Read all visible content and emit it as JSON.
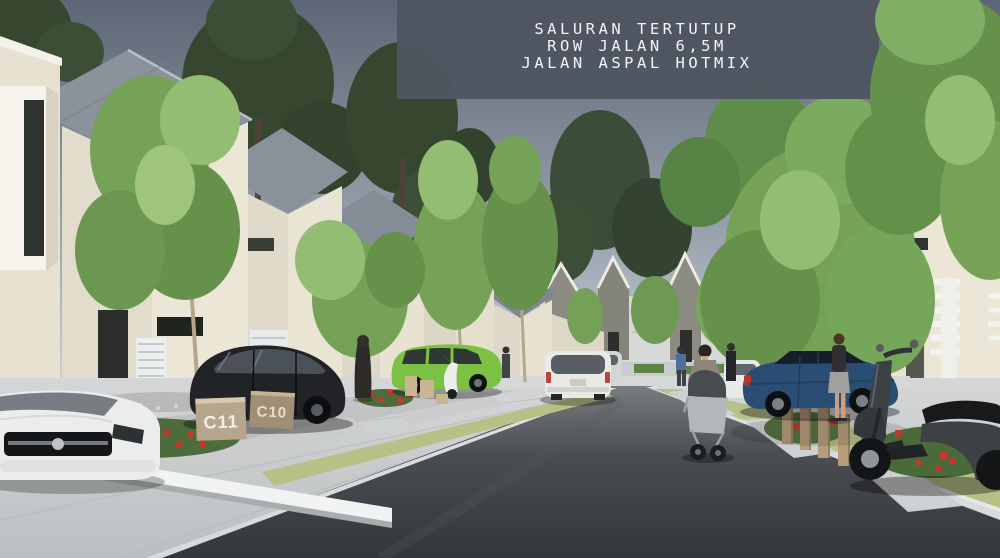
{
  "banner": {
    "lines": [
      "SALURAN TERTUTUP",
      "ROW JALAN 6,5M",
      "JALAN ASPAL HOTMIX"
    ],
    "bg_color": "#4e5561",
    "text_color": "#f3f4f6"
  },
  "unit_signs": {
    "sign_1": "C11",
    "sign_2": "C10"
  },
  "colors": {
    "sky_top": "#5d6675",
    "sky_mid": "#99a2ad",
    "sky_horizon": "#d7dce1",
    "asphalt_far": "#7a7d80",
    "asphalt_mid": "#4a4d51",
    "asphalt_near": "#33363a",
    "sidewalk": "#c8cbcd",
    "curb": "#e9ebec",
    "verge_green": "#b7c187",
    "house_wall": "#e7e1d2",
    "roof_gray": "#8b929b",
    "gable_facade": "#8b8b81",
    "slat_wall": "#d7d9d6",
    "pine_green": "#36462f",
    "tree_green": "#76a258",
    "tree_green_dark": "#65914b",
    "tree_green_light": "#93bd72",
    "flower_red": "#c0392b",
    "flower_bed_green": "#4e6b3c",
    "car_black": "#212326",
    "car_green": "#7cc143",
    "car_blue": "#2a4d74",
    "car_white": "#ebedec",
    "van_white": "#e9e9e6",
    "scooter_gray": "#3c4144",
    "sign_stone": "#b6a68c",
    "wood_post": "#b59c7c"
  }
}
